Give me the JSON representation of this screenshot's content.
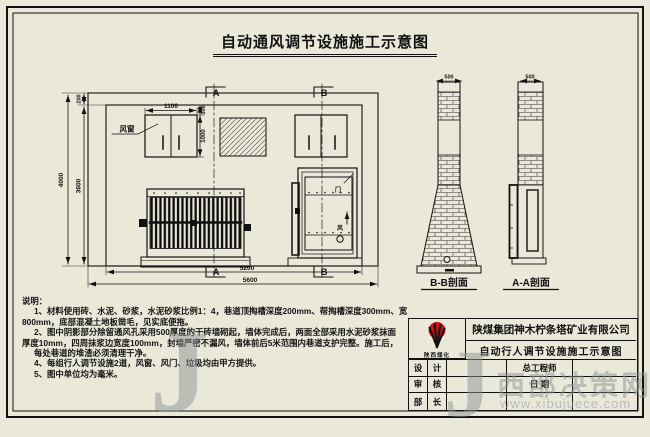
{
  "title": {
    "main": "自动通风调节设施施工示意图"
  },
  "drawing": {
    "marks": {
      "a": "A",
      "b": "B"
    },
    "labels": {
      "window": "风窗",
      "door_top": "门",
      "door_mid": "风"
    },
    "dims": {
      "total_h": "4000",
      "inner_h": "3600",
      "top_slot": "200",
      "win_w": "1100",
      "win_gap": "300",
      "win_h": "1000",
      "inner_w": "5200",
      "outer_w": "5600",
      "bb_thk": "500",
      "aa_thk": "500"
    }
  },
  "sections": {
    "bb": "B-B剖面",
    "aa": "A-A剖面"
  },
  "notes": {
    "heading": "说明：",
    "lines": [
      "1、材料使用砖、水泥、砂浆，水泥砂浆比例1：4，巷道顶掏槽深度200mm、帮掏槽深度300mm、宽",
      "800mm，底部混凝土地板凿毛，见实底便拖。",
      "2、图中阴影部分除留通风孔采用500厚度的干砖墙砌起，墙体完成后，两面全部采用水泥砂浆抹面",
      "厚度10mm，四周抹浆边宽度100mm，封墙严密不漏风，墙体前后5米范围内巷道支护完整。施工后，",
      "每处巷道的堆渣必须清理干净。",
      "4、每组行人调节设施2道，风窗、风门、垃圾均由甲方提供。",
      "5、图中单位均为毫米。"
    ]
  },
  "title_block": {
    "company": "陕煤集团神木柠条塔矿业有限公司",
    "drawing_title": "自动行人调节设施施工示意图",
    "logo_text": "陕西煤化",
    "grid": [
      [
        "设",
        "计",
        "",
        "总工程师",
        ""
      ],
      [
        "审",
        "核",
        "",
        "日 期",
        ""
      ],
      [
        "部",
        "长",
        "",
        "",
        ""
      ]
    ]
  },
  "watermark": {
    "j": "J",
    "site": "西部决策网",
    "url": "www.xibujuece.com"
  },
  "colors": {
    "paper": "#eae8d9",
    "line": "#111111",
    "logo_red": "#cc1111",
    "watermark": "#8a9393"
  }
}
